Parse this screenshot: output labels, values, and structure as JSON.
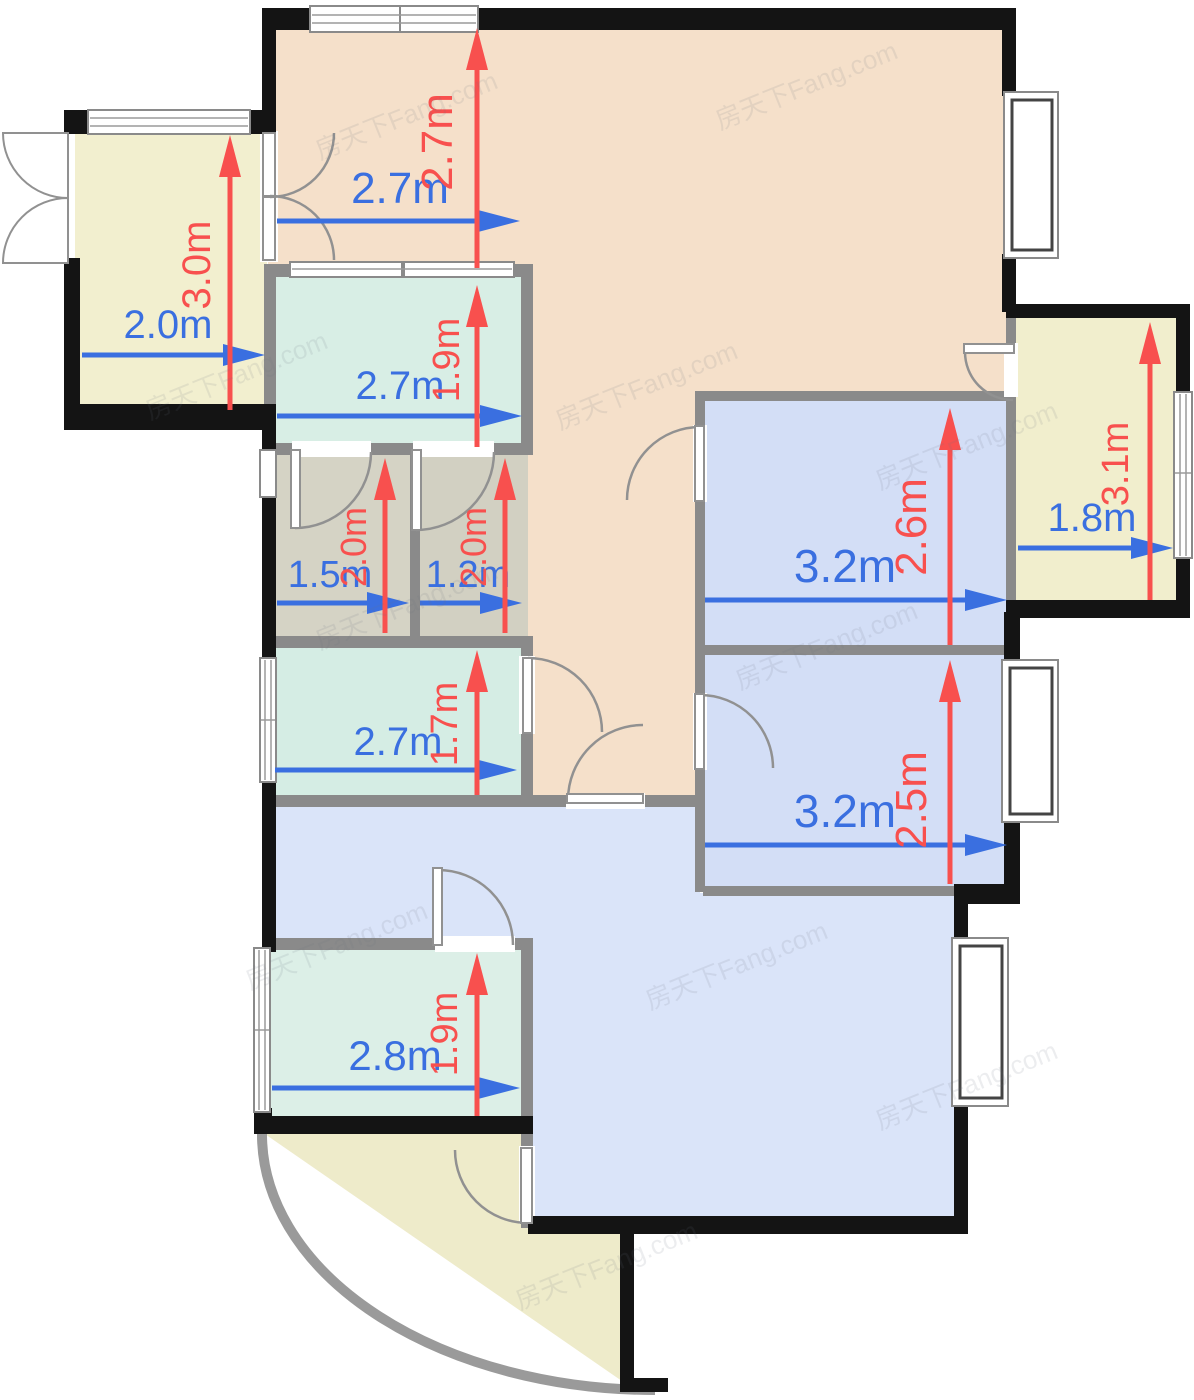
{
  "watermark": {
    "text": "房天下Fang.com"
  },
  "colors": {
    "dining_peach": "#f5e0ca",
    "mint_room": "#d8eee5",
    "bath_gray": "#d5d3c5",
    "balcony_cream": "#f2efcf",
    "bedroom_blue": "#d3def6",
    "living_blue": "#dae4f9",
    "exterior_wall": "#141414",
    "interior_wall": "#8a8a8a",
    "dim_blue": "#3a6fe0",
    "dim_red": "#f8504e"
  },
  "dimensions": {
    "balcony_top_left": {
      "width": "2.0m",
      "depth": "3.0m"
    },
    "dining": {
      "width": "2.7m",
      "depth": "2.7m"
    },
    "room_mint_top": {
      "width": "2.7m",
      "depth": "1.9m"
    },
    "bath_left": {
      "width": "1.5m",
      "depth": "2.0m"
    },
    "bath_right": {
      "width": "1.2m",
      "depth": "2.0m"
    },
    "room_mint_middle": {
      "width": "2.7m",
      "depth": "1.7m"
    },
    "bedroom_top_right": {
      "width": "3.2m",
      "depth": "2.6m"
    },
    "bedroom_bottom_right": {
      "width": "3.2m",
      "depth": "2.5m"
    },
    "balcony_right": {
      "width": "1.8m",
      "depth": "3.1m"
    },
    "kitchen": {
      "width": "2.8m",
      "depth": "1.9m"
    }
  }
}
